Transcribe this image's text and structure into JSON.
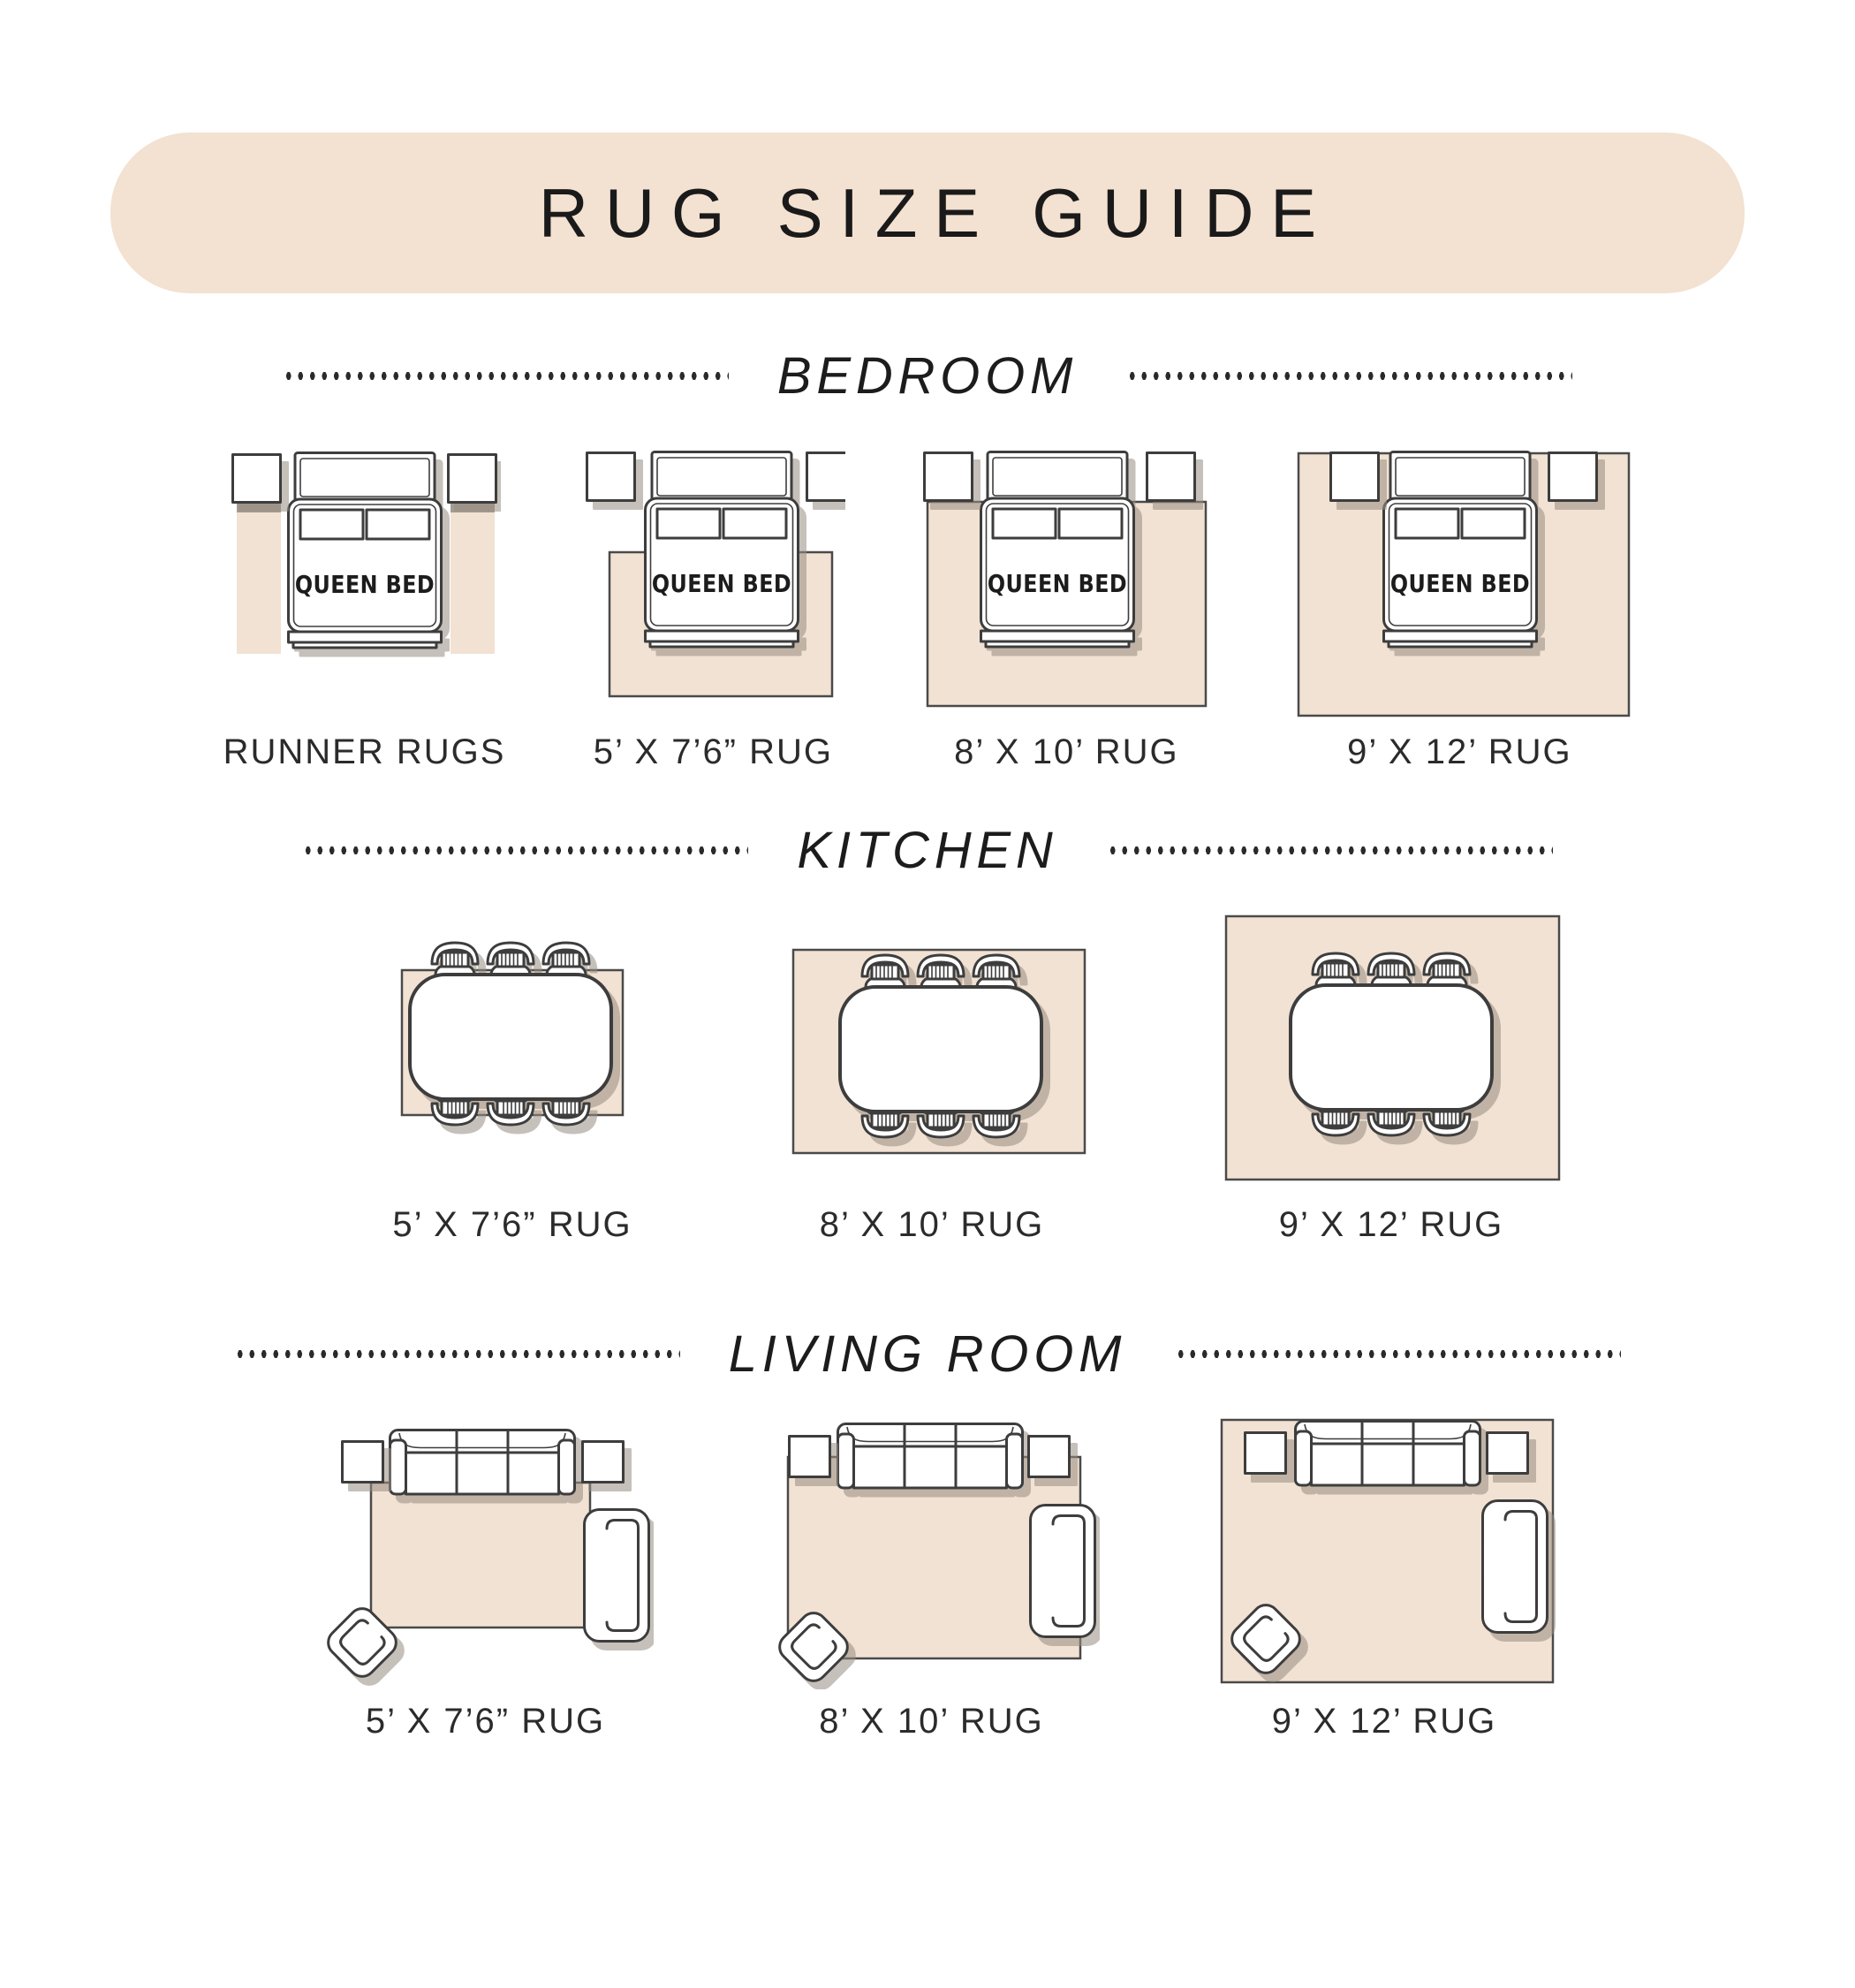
{
  "title": "RUG SIZE GUIDE",
  "bed_label": "QUEEN BED",
  "colors": {
    "banner_bg": "#f3e1d1",
    "rug_fill": "#f2e2d3",
    "outline": "#3e3e3e",
    "text": "#2b2b2b",
    "runner_shadow": "#a49c93"
  },
  "sections": {
    "bedroom": {
      "heading": "BEDROOM",
      "figures": [
        {
          "caption": "RUNNER RUGS",
          "icons": [
            "queen-bed-icon",
            "nightstand-icon",
            "runner-rug"
          ]
        },
        {
          "caption": "5’ X 7’6” RUG",
          "icons": [
            "queen-bed-icon",
            "nightstand-icon",
            "area-rug"
          ]
        },
        {
          "caption": "8’ X 10’ RUG",
          "icons": [
            "queen-bed-icon",
            "nightstand-icon",
            "area-rug"
          ]
        },
        {
          "caption": "9’ X 12’ RUG",
          "icons": [
            "queen-bed-icon",
            "nightstand-icon",
            "area-rug"
          ]
        }
      ]
    },
    "kitchen": {
      "heading": "KITCHEN",
      "figures": [
        {
          "caption": "5’ X 7’6” RUG",
          "icons": [
            "dining-table-icon",
            "dining-chair-icon",
            "area-rug"
          ]
        },
        {
          "caption": "8’ X 10’ RUG",
          "icons": [
            "dining-table-icon",
            "dining-chair-icon",
            "area-rug"
          ]
        },
        {
          "caption": "9’ X 12’ RUG",
          "icons": [
            "dining-table-icon",
            "dining-chair-icon",
            "area-rug"
          ]
        }
      ]
    },
    "living_room": {
      "heading": "LIVING ROOM",
      "figures": [
        {
          "caption": "5’ X 7’6” RUG",
          "icons": [
            "sofa-icon",
            "side-table-icon",
            "armchair-icon",
            "accent-chair-icon",
            "area-rug"
          ]
        },
        {
          "caption": "8’ X 10’ RUG",
          "icons": [
            "sofa-icon",
            "side-table-icon",
            "armchair-icon",
            "accent-chair-icon",
            "area-rug"
          ]
        },
        {
          "caption": "9’ X 12’ RUG",
          "icons": [
            "sofa-icon",
            "side-table-icon",
            "armchair-icon",
            "accent-chair-icon",
            "area-rug"
          ]
        }
      ]
    }
  }
}
